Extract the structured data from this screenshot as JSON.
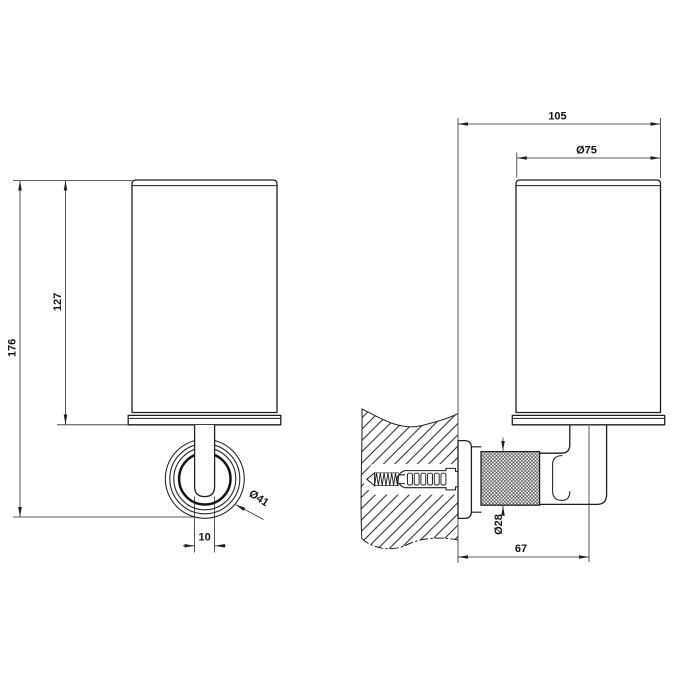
{
  "front_view": {
    "overall_height": "176",
    "cup_height": "127",
    "rosette_diameter": "Ø41",
    "stem_width": "10"
  },
  "side_view": {
    "overall_depth": "105",
    "cup_diameter": "Ø75",
    "knurl_diameter": "Ø28",
    "wall_to_cup_axis": "67"
  }
}
